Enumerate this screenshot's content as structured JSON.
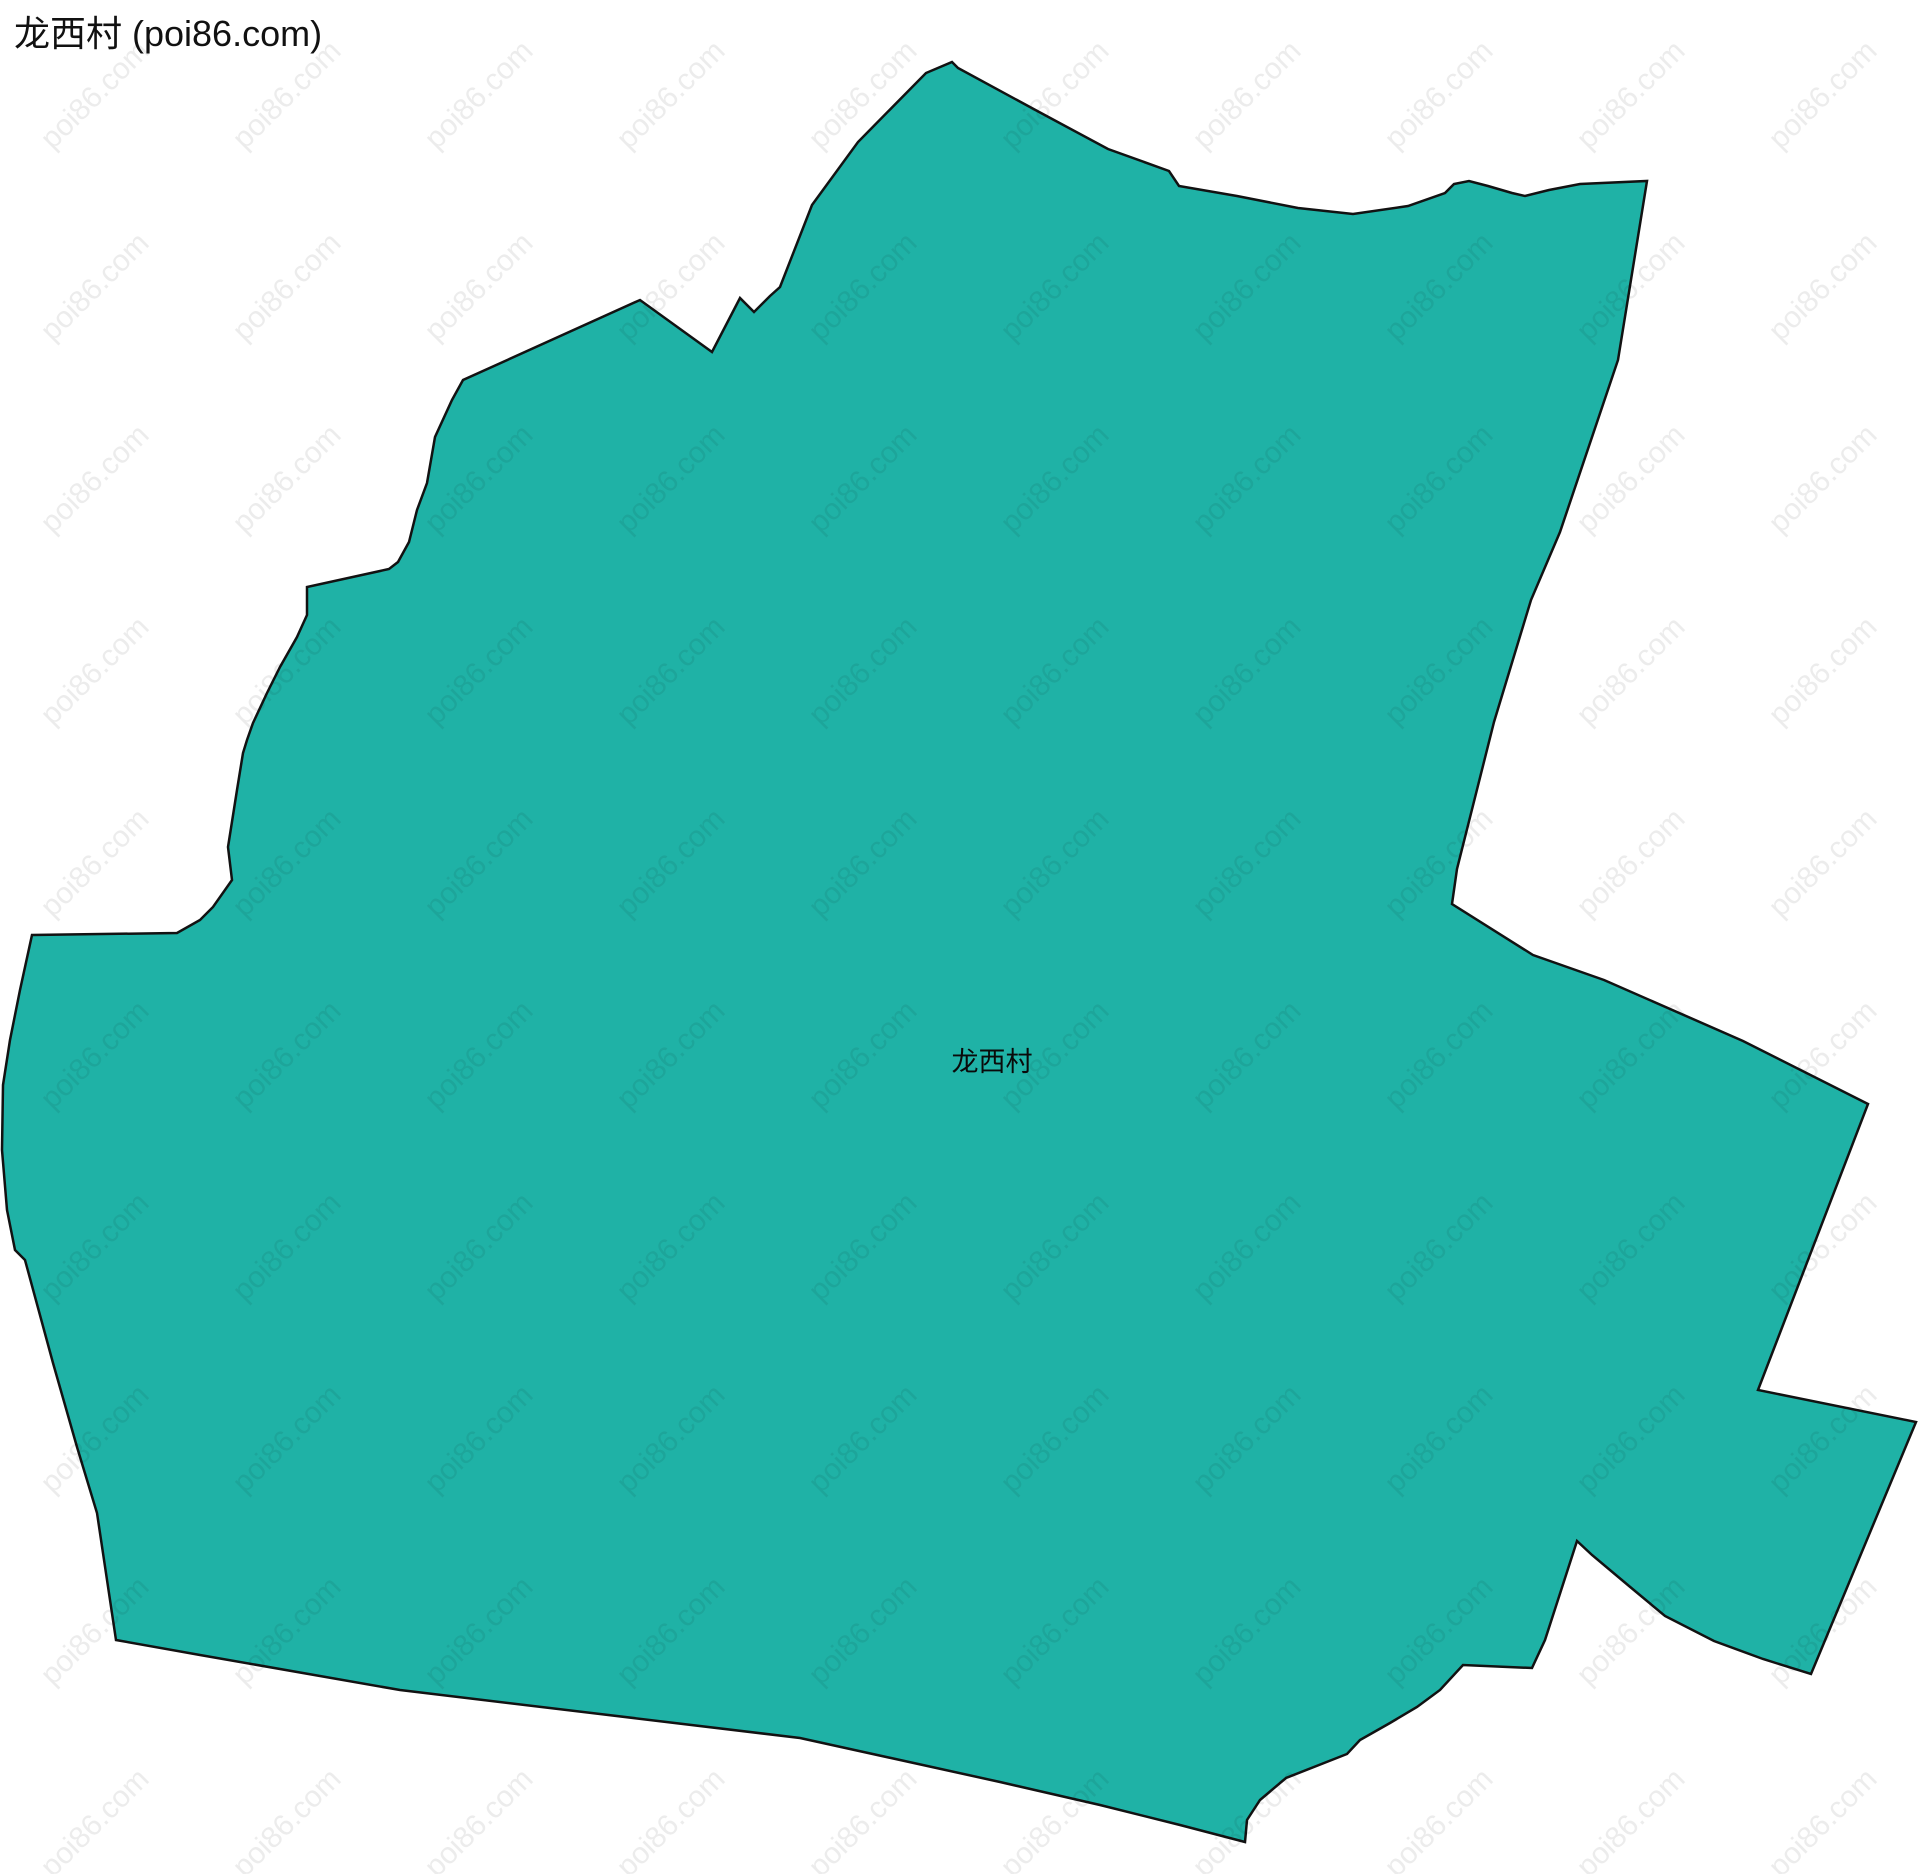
{
  "page": {
    "title": "龙西村 (poi86.com)",
    "background_color": "#ffffff"
  },
  "map": {
    "region_label": "龙西村",
    "fill_color": "#1fb2a6",
    "border_color": "#121212",
    "border_width": "2.5",
    "label_color": "#0a0a0a",
    "label_font_size": "27",
    "label_x": "992",
    "label_y": "1071",
    "polygon_points": "952,62 958,68 1041,113 1108,149 1169,171 1179,186 1237,196 1298,208 1353,214 1408,206 1445,193 1454,184 1469,181 1488,186 1512,193 1525,196 1549,190 1580,184 1647,181 1618,360 1560,532 1531,600 1494,722 1457,869 1452,904 1533,955 1604,980 1743,1041 1868,1104 1758,1390 1916,1422 1811,1674 1763,1659 1714,1641 1665,1616 1629,1586 1592,1555 1577,1541 1545,1640 1532,1668 1463,1665 1440,1690 1417,1707 1390,1723 1360,1740 1347,1754 1286,1778 1260,1800 1247,1820 1245,1842 1180,1825 1100,1805 1000,1782 800,1738 600,1714 400,1690 200,1655 116,1640 97,1513 77,1447 53,1363 25,1260 15,1250 7,1210 2,1150 3,1085 10,1040 20,990 32,935 177,933 200,920 213,907 232,880 228,847 237,790 243,753 247,740 253,723 267,693 280,667 297,637 307,615 307,587 389,569 398,562 409,542 417,510 427,483 435,437 452,400 463,380 640,300 712,352 740,298 754,312 770,296 780,287 812,205 858,142 926,73"
  },
  "title_style": {
    "x": "14",
    "y": "46",
    "font_size": "36",
    "color": "#111111"
  },
  "watermark": {
    "text": "poi86.com",
    "color": "#000000",
    "opacity": "0.075",
    "font_size": "30",
    "tile_size": "192"
  }
}
